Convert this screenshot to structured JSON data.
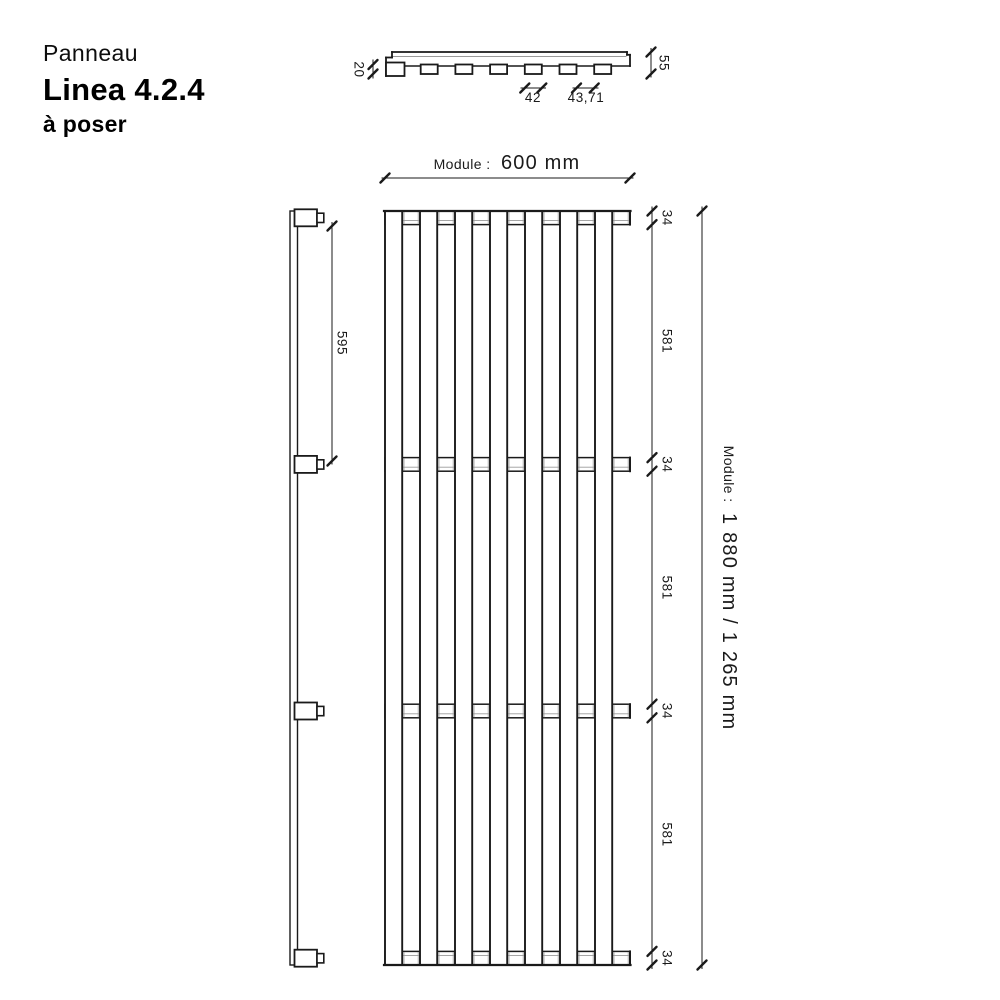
{
  "title": {
    "product_type": "Panneau",
    "product_name": "Linea 4.2.4",
    "mounting": "à poser"
  },
  "section_view": {
    "slat_thickness": "20",
    "total_depth": "55",
    "slat_width": "42",
    "slat_gap": "43,71"
  },
  "front_view": {
    "module_width_label": "Module :",
    "module_width_value": "600 mm"
  },
  "side_view": {
    "rail_spacing": "595"
  },
  "height_dims": {
    "chain": [
      "34",
      "581",
      "34",
      "581",
      "34",
      "581",
      "34"
    ],
    "module_height_label": "Module :",
    "module_height_value": "1 880 mm / 1 265 mm"
  },
  "colors": {
    "line": "#1a1a1a",
    "thin_line": "#9a9a9a",
    "background": "#ffffff"
  }
}
